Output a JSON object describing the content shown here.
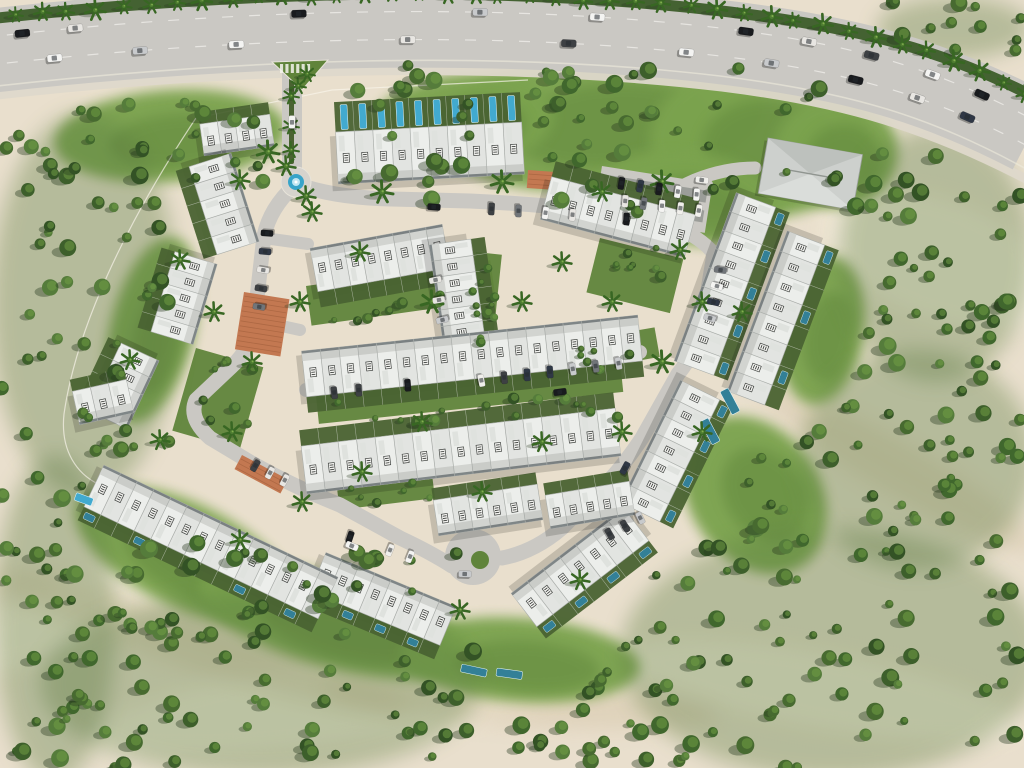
{
  "meta": {
    "title": "Aerial 3D masterplan render of a townhouse community surrounded by desert",
    "canvas": {
      "w": 1024,
      "h": 768
    }
  },
  "palette": {
    "sand": "#e9dfcc",
    "sandLight": "#f5eedd",
    "sandDark": "#d3c3a4",
    "grass": "#79a24b",
    "grassDeep": "#5d8238",
    "understory": "#55763a",
    "treeGreens": [
      "#2f4f21",
      "#3a5c27",
      "#44682c",
      "#527a38",
      "#3d6429"
    ],
    "treeHighlight": "#6d9a42",
    "palmGreen": "#35641f",
    "road": "#c9c7c2",
    "roadLight": "#d6d3cd",
    "sidewalk": "#ded8ca",
    "lotDark": "#8a8d88",
    "roofWhite": "#eceeeb",
    "roofBand": "#d2d4d0",
    "roofEdge": "#a9ada9",
    "skylight": "#dfe2de",
    "facadeDark": "#6e7678",
    "gardenGreen": "#47602e",
    "poolBlue": "#3fa9cf",
    "poolTeal": "#2f7e95",
    "poolLight": "#bfe6f2",
    "fountainBlue": "#35a3c8",
    "terracotta": "#c2764e",
    "terracottaLine": "#a35f3b",
    "boundaryLine": "#f8f4ea",
    "carColors": [
      "#f4f4f2",
      "#15171a",
      "#c7c9cb",
      "#6f7377",
      "#2b3442",
      "#e8e6e2",
      "#3a3d40",
      "#f0efeb"
    ]
  },
  "scene": {
    "highway": {
      "roadPath": "M -20,52 C 240,22 500,16 720,42 C 855,58 935,82 1032,132",
      "roadWidth": 84,
      "medianPath": "M -20,20 C 240,-10 500,-16 730,12 C 860,28 945,50 1040,100",
      "medianWidth": 11,
      "laneDash0": "M -20,38 C 240,8 500,2 720,28 C 850,44 930,66 1030,118",
      "laneDash1": "M -20,66 C 240,36 500,30 720,56 C 850,72 935,96 1035,150",
      "edgeLine": "M -20,88 C 240,58 500,50 720,76 C 850,92 930,116 1030,171",
      "sidewalkPath": "M -20,97 C 240,67 500,61 722,87 C 850,103 928,129 1026,179",
      "sidewalkWidth": 9,
      "palmSpacing": 27
    },
    "roads": [
      {
        "d": "M292,58 L292,172",
        "w": 20
      },
      {
        "d": "M296,184 Q336,198 392,199 L470,201 Q540,204 600,212 Q646,218 668,224 Q696,212 702,196 L706,186",
        "w": 15
      },
      {
        "d": "M668,224 Q700,236 714,254",
        "w": 14
      },
      {
        "d": "M294,186 Q270,208 264,236 L254,324 Q250,350 232,366 L196,400 Q188,418 210,438 L250,462 Q290,485 340,505 L400,538 Q430,552 452,566",
        "w": 15
      },
      {
        "d": "M714,254 L702,326 Q696,352 678,374 L642,438 Q622,468 602,488 L562,528 Q534,552 502,558",
        "w": 15
      },
      {
        "d": "M306,390 L460,374 Q560,362 640,352",
        "w": 14
      },
      {
        "d": "M264,238 L308,244",
        "w": 12
      },
      {
        "d": "M254,320 L300,330",
        "w": 12
      },
      {
        "d": "M640,222 Q660,195 695,180 Q725,168 755,168",
        "w": 13
      },
      {
        "d": "M436,250 L452,330",
        "w": 10
      }
    ],
    "entrance": {
      "medianStrip": {
        "x": 289,
        "y": 78,
        "w": 5,
        "h": 86
      },
      "triangleIsland": "272,62 328,60 302,90",
      "crosswalk": {
        "x": 280,
        "y": 64,
        "stripes": 6
      }
    },
    "roundabout": {
      "cx": 296,
      "cy": 182,
      "r": 15,
      "fountainR": 8,
      "innerR": 4
    },
    "culdesac": {
      "cx": 473,
      "cy": 557,
      "r": 28,
      "islandCx": 480,
      "islandCy": 560,
      "islandR": 9
    },
    "greenBlobs": [
      {
        "cx": 600,
        "cy": 120,
        "rx": 165,
        "ry": 70,
        "rot": -5
      },
      {
        "cx": 760,
        "cy": 140,
        "rx": 110,
        "ry": 78,
        "rot": 0
      },
      {
        "cx": 462,
        "cy": 122,
        "rx": 92,
        "ry": 48,
        "rot": -6
      },
      {
        "cx": 690,
        "cy": 198,
        "rx": 92,
        "ry": 46,
        "rot": 8
      },
      {
        "cx": 836,
        "cy": 152,
        "rx": 62,
        "ry": 56,
        "rot": 0
      },
      {
        "cx": 170,
        "cy": 136,
        "rx": 116,
        "ry": 46,
        "rot": -4
      },
      {
        "cx": 185,
        "cy": 555,
        "rx": 120,
        "ry": 52,
        "rot": 26
      },
      {
        "cx": 335,
        "cy": 622,
        "rx": 140,
        "ry": 46,
        "rot": 15
      },
      {
        "cx": 520,
        "cy": 660,
        "rx": 120,
        "ry": 42,
        "rot": 4
      },
      {
        "cx": 755,
        "cy": 495,
        "rx": 65,
        "ry": 85,
        "rot": -35
      },
      {
        "cx": 822,
        "cy": 330,
        "rx": 42,
        "ry": 75,
        "rot": 8
      },
      {
        "cx": 152,
        "cy": 330,
        "rx": 42,
        "ry": 95,
        "rot": 14
      }
    ],
    "courtyards": [
      {
        "x": 306,
        "y": 286,
        "w": 186,
        "h": 40,
        "rot": -8
      },
      {
        "x": 316,
        "y": 396,
        "w": 306,
        "h": 28,
        "rot": -6
      },
      {
        "x": 476,
        "y": 252,
        "w": 26,
        "h": 96,
        "rot": 6
      },
      {
        "x": 560,
        "y": 344,
        "w": 96,
        "h": 30,
        "rot": -10
      },
      {
        "x": 600,
        "y": 238,
        "w": 86,
        "h": 56,
        "rot": 14
      },
      {
        "x": 196,
        "y": 348,
        "w": 70,
        "h": 86,
        "rot": 16
      },
      {
        "x": 336,
        "y": 480,
        "w": 96,
        "h": 30,
        "rot": -7
      }
    ],
    "dunesLight": [
      [
        350,
        700,
        260,
        42,
        -8
      ],
      [
        820,
        690,
        200,
        38,
        10
      ],
      [
        60,
        620,
        160,
        32,
        -20
      ],
      [
        940,
        260,
        120,
        60,
        20
      ]
    ],
    "dunesDark": [
      [
        200,
        642,
        220,
        28,
        18
      ],
      [
        900,
        470,
        160,
        26,
        30
      ],
      [
        520,
        702,
        200,
        24,
        4
      ]
    ],
    "boundaryLines": [
      "M196,118 C 124,226 76,330 64,414 C 60,452 78,474 98,484",
      "M196,118 L332,90 L528,80"
    ],
    "rows": [
      {
        "id": "north-row",
        "x1": 337,
        "y1": 158,
        "x2": 523,
        "y2": 148,
        "d": 52,
        "u": 10,
        "g": 1,
        "gd": 30,
        "pool": {
          "perp": true,
          "every": 1,
          "color": "blue"
        }
      },
      {
        "id": "nw-row-a",
        "x1": 202,
        "y1": 140,
        "x2": 272,
        "y2": 130,
        "d": 32,
        "u": 4,
        "g": 1,
        "gd": 12
      },
      {
        "id": "nw-row-b",
        "x1": 210,
        "y1": 160,
        "x2": 238,
        "y2": 248,
        "d": 44,
        "u": 5,
        "g": -1,
        "gd": 14
      },
      {
        "id": "nw-row-c",
        "x1": 196,
        "y1": 258,
        "x2": 172,
        "y2": 338,
        "d": 44,
        "u": 5,
        "g": -1,
        "gd": 14
      },
      {
        "id": "w-row-a",
        "x1": 140,
        "y1": 352,
        "x2": 108,
        "y2": 420,
        "d": 42,
        "u": 4,
        "g": -1,
        "gd": 14
      },
      {
        "id": "w-row-b",
        "x1": 76,
        "y1": 408,
        "x2": 130,
        "y2": 396,
        "d": 34,
        "u": 3,
        "g": 1,
        "gd": 12
      },
      {
        "id": "ne-row",
        "x1": 546,
        "y1": 198,
        "x2": 690,
        "y2": 236,
        "d": 44,
        "u": 8,
        "g": 1,
        "gd": 16
      },
      {
        "id": "e-row-inner",
        "x1": 756,
        "y1": 200,
        "x2": 694,
        "y2": 368,
        "d": 42,
        "u": 9,
        "g": 1,
        "gd": 15,
        "pool": {
          "every": 2,
          "color": "teal"
        }
      },
      {
        "id": "e-row-outer",
        "x1": 806,
        "y1": 238,
        "x2": 746,
        "y2": 398,
        "d": 40,
        "u": 8,
        "g": 1,
        "gd": 15,
        "pool": {
          "every": 3,
          "color": "teal"
        }
      },
      {
        "id": "se-row-a",
        "x1": 700,
        "y1": 390,
        "x2": 640,
        "y2": 512,
        "d": 44,
        "u": 7,
        "g": 1,
        "gd": 15,
        "pool": {
          "every": 2,
          "color": "teal"
        }
      },
      {
        "id": "se-row-b",
        "x1": 636,
        "y1": 524,
        "x2": 524,
        "y2": 610,
        "d": 42,
        "u": 7,
        "g": 1,
        "gd": 15,
        "pool": {
          "every": 2,
          "color": "teal"
        }
      },
      {
        "id": "s-v-left-row",
        "x1": 318,
        "y1": 572,
        "x2": 448,
        "y2": 626,
        "d": 42,
        "u": 8,
        "g": -1,
        "gd": 15,
        "pool": {
          "every": 2,
          "color": "teal"
        }
      },
      {
        "id": "sw-long-row",
        "x1": 94,
        "y1": 486,
        "x2": 328,
        "y2": 598,
        "d": 46,
        "u": 14,
        "g": -1,
        "gd": 15,
        "pool": {
          "every": 3,
          "color": "teal"
        }
      },
      {
        "id": "s-mid-row",
        "x1": 436,
        "y1": 518,
        "x2": 540,
        "y2": 502,
        "d": 36,
        "u": 6,
        "g": 1,
        "gd": 12
      },
      {
        "id": "s-mid-row-2",
        "x1": 548,
        "y1": 512,
        "x2": 632,
        "y2": 498,
        "d": 34,
        "u": 5,
        "g": 1,
        "gd": 12
      },
      {
        "id": "central-row-1",
        "x1": 314,
        "y1": 270,
        "x2": 446,
        "y2": 246,
        "d": 44,
        "u": 8,
        "g": -1,
        "gd": 16
      },
      {
        "id": "central-vertical-row",
        "x1": 450,
        "y1": 242,
        "x2": 464,
        "y2": 340,
        "d": 42,
        "u": 6,
        "g": 1,
        "gd": 14
      },
      {
        "id": "central-row-2",
        "x1": 304,
        "y1": 374,
        "x2": 640,
        "y2": 338,
        "d": 46,
        "u": 18,
        "g": -1,
        "gd": 16
      },
      {
        "id": "central-row-3",
        "x1": 304,
        "y1": 470,
        "x2": 618,
        "y2": 432,
        "d": 48,
        "u": 17,
        "g": 1,
        "gd": 16
      }
    ],
    "clubhouse": {
      "x": 768,
      "y": 138,
      "w": 96,
      "h": 56,
      "rot": 10
    },
    "parkingLots": [
      {
        "x": 602,
        "y": 166,
        "w": 112,
        "h": 50,
        "rot": 9,
        "dark": true
      }
    ],
    "terracotta": [
      {
        "x": 244,
        "y": 292,
        "w": 46,
        "h": 58,
        "rot": 9
      },
      {
        "x": 242,
        "y": 455,
        "w": 52,
        "h": 16,
        "rot": 28
      },
      {
        "x": 528,
        "y": 170,
        "w": 26,
        "h": 18,
        "rot": 4
      }
    ],
    "parkingStrips": [
      {
        "x1": 478,
        "y1": 208,
        "x2": 640,
        "y2": 220,
        "n": 6
      },
      {
        "x1": 612,
        "y1": 182,
        "x2": 706,
        "y2": 196,
        "n": 5
      },
      {
        "x1": 616,
        "y1": 200,
        "x2": 708,
        "y2": 212,
        "n": 5
      },
      {
        "x1": 722,
        "y1": 262,
        "x2": 708,
        "y2": 326,
        "n": 4
      },
      {
        "x1": 470,
        "y1": 382,
        "x2": 630,
        "y2": 362,
        "n": 7
      },
      {
        "x1": 322,
        "y1": 394,
        "x2": 420,
        "y2": 384,
        "n": 4
      },
      {
        "x1": 268,
        "y1": 224,
        "x2": 258,
        "y2": 316,
        "n": 5
      },
      {
        "x1": 340,
        "y1": 534,
        "x2": 420,
        "y2": 560,
        "n": 4
      },
      {
        "x1": 602,
        "y1": 538,
        "x2": 648,
        "y2": 514,
        "n": 3
      },
      {
        "x1": 248,
        "y1": 462,
        "x2": 292,
        "y2": 484,
        "n": 3
      },
      {
        "x1": 430,
        "y1": 250,
        "x2": 444,
        "y2": 330,
        "n": 4
      }
    ],
    "looseCars": [
      [
        292,
        122,
        -89,
        0
      ],
      [
        434,
        207,
        4,
        1
      ],
      [
        560,
        392,
        -8,
        1
      ],
      [
        352,
        546,
        23,
        0
      ],
      [
        625,
        468,
        -62,
        4
      ],
      [
        465,
        574,
        2,
        2
      ],
      [
        702,
        180,
        8,
        7
      ]
    ],
    "highwayCars": {
      "lane0": [
        [
          0.04,
          1
        ],
        [
          0.09,
          5
        ],
        [
          0.3,
          1
        ],
        [
          0.47,
          2
        ],
        [
          0.58,
          0
        ],
        [
          0.72,
          1
        ],
        [
          0.78,
          5
        ],
        [
          0.84,
          6
        ],
        [
          0.9,
          0
        ],
        [
          0.95,
          1
        ]
      ],
      "lane1": [
        [
          0.07,
          0
        ],
        [
          0.15,
          2
        ],
        [
          0.24,
          0
        ],
        [
          0.4,
          5
        ],
        [
          0.55,
          6
        ],
        [
          0.66,
          0
        ],
        [
          0.74,
          2
        ],
        [
          0.82,
          1
        ],
        [
          0.88,
          5
        ],
        [
          0.93,
          4
        ]
      ]
    },
    "standalonePools": [
      {
        "x": 74,
        "y": 500,
        "w": 8,
        "h": 18,
        "rot": -70,
        "color": "blue"
      },
      {
        "x": 462,
        "y": 664,
        "w": 26,
        "h": 8,
        "rot": 12,
        "color": "teal"
      },
      {
        "x": 497,
        "y": 668,
        "w": 26,
        "h": 8,
        "rot": 8,
        "color": "teal"
      },
      {
        "x": 700,
        "y": 422,
        "w": 9,
        "h": 26,
        "rot": -28,
        "color": "teal"
      },
      {
        "x": 720,
        "y": 392,
        "w": 9,
        "h": 26,
        "rot": -28,
        "color": "teal"
      }
    ],
    "treeClusters": [
      {
        "x": 0,
        "y": 130,
        "w": 170,
        "h": 350,
        "n": 48,
        "blob": true
      },
      {
        "x": 0,
        "y": 470,
        "w": 110,
        "h": 298,
        "n": 30,
        "blob": true
      },
      {
        "x": 60,
        "y": 600,
        "w": 400,
        "h": 168,
        "n": 46,
        "blob": true
      },
      {
        "x": 430,
        "y": 640,
        "w": 270,
        "h": 128,
        "n": 30,
        "blob": false
      },
      {
        "x": 640,
        "y": 540,
        "w": 384,
        "h": 228,
        "n": 54,
        "blob": true
      },
      {
        "x": 810,
        "y": 360,
        "w": 214,
        "h": 200,
        "n": 34,
        "blob": true
      },
      {
        "x": 848,
        "y": 140,
        "w": 176,
        "h": 230,
        "n": 38,
        "blob": true
      },
      {
        "x": 884,
        "y": 0,
        "w": 140,
        "h": 56,
        "n": 12,
        "blob": true
      },
      {
        "x": 340,
        "y": 62,
        "w": 510,
        "h": 150,
        "n": 56,
        "blob": false
      },
      {
        "x": 120,
        "y": 540,
        "w": 340,
        "h": 100,
        "n": 30,
        "blob": false
      },
      {
        "x": 742,
        "y": 428,
        "w": 80,
        "h": 120,
        "n": 12,
        "blob": false
      },
      {
        "x": 60,
        "y": 100,
        "w": 215,
        "h": 82,
        "n": 16,
        "blob": false
      },
      {
        "x": 310,
        "y": 290,
        "w": 180,
        "h": 38,
        "n": 13,
        "rmin": 3,
        "rmax": 6,
        "blob": false
      },
      {
        "x": 320,
        "y": 398,
        "w": 300,
        "h": 26,
        "n": 15,
        "rmin": 3,
        "rmax": 6,
        "blob": false
      },
      {
        "x": 478,
        "y": 252,
        "w": 24,
        "h": 96,
        "n": 7,
        "rmin": 3,
        "rmax": 5,
        "blob": false
      },
      {
        "x": 600,
        "y": 240,
        "w": 84,
        "h": 56,
        "n": 8,
        "rmin": 3,
        "rmax": 6,
        "blob": false
      },
      {
        "x": 560,
        "y": 346,
        "w": 92,
        "h": 28,
        "n": 7,
        "rmin": 3,
        "rmax": 5,
        "blob": false
      },
      {
        "x": 198,
        "y": 350,
        "w": 60,
        "h": 84,
        "n": 8,
        "rmin": 3,
        "rmax": 6,
        "blob": false
      },
      {
        "x": 338,
        "y": 482,
        "w": 96,
        "h": 28,
        "n": 6,
        "rmin": 3,
        "rmax": 5,
        "blob": false
      }
    ],
    "palms": [
      [
        268,
        152,
        7
      ],
      [
        312,
        212,
        6
      ],
      [
        360,
        252,
        6
      ],
      [
        300,
        302,
        6
      ],
      [
        252,
        362,
        6
      ],
      [
        214,
        312,
        6
      ],
      [
        432,
        302,
        7
      ],
      [
        522,
        302,
        6
      ],
      [
        562,
        262,
        6
      ],
      [
        612,
        302,
        6
      ],
      [
        662,
        362,
        7
      ],
      [
        702,
        302,
        6
      ],
      [
        422,
        422,
        6
      ],
      [
        362,
        472,
        6
      ],
      [
        542,
        442,
        6
      ],
      [
        622,
        432,
        6
      ],
      [
        302,
        502,
        6
      ],
      [
        482,
        492,
        6
      ],
      [
        702,
        432,
        6
      ],
      [
        742,
        312,
        6
      ],
      [
        662,
        182,
        7
      ],
      [
        602,
        192,
        6
      ],
      [
        502,
        182,
        7
      ],
      [
        382,
        192,
        7
      ],
      [
        232,
        432,
        6
      ],
      [
        286,
        166,
        6
      ],
      [
        306,
        196,
        6
      ],
      [
        291,
        96,
        5
      ],
      [
        291,
        126,
        5
      ],
      [
        291,
        150,
        5
      ],
      [
        298,
        86,
        5
      ],
      [
        307,
        74,
        5
      ],
      [
        680,
        250,
        6
      ],
      [
        580,
        580,
        6
      ],
      [
        460,
        610,
        6
      ],
      [
        240,
        540,
        6
      ],
      [
        160,
        440,
        6
      ],
      [
        130,
        360,
        6
      ],
      [
        180,
        260,
        6
      ],
      [
        240,
        180,
        6
      ]
    ]
  }
}
